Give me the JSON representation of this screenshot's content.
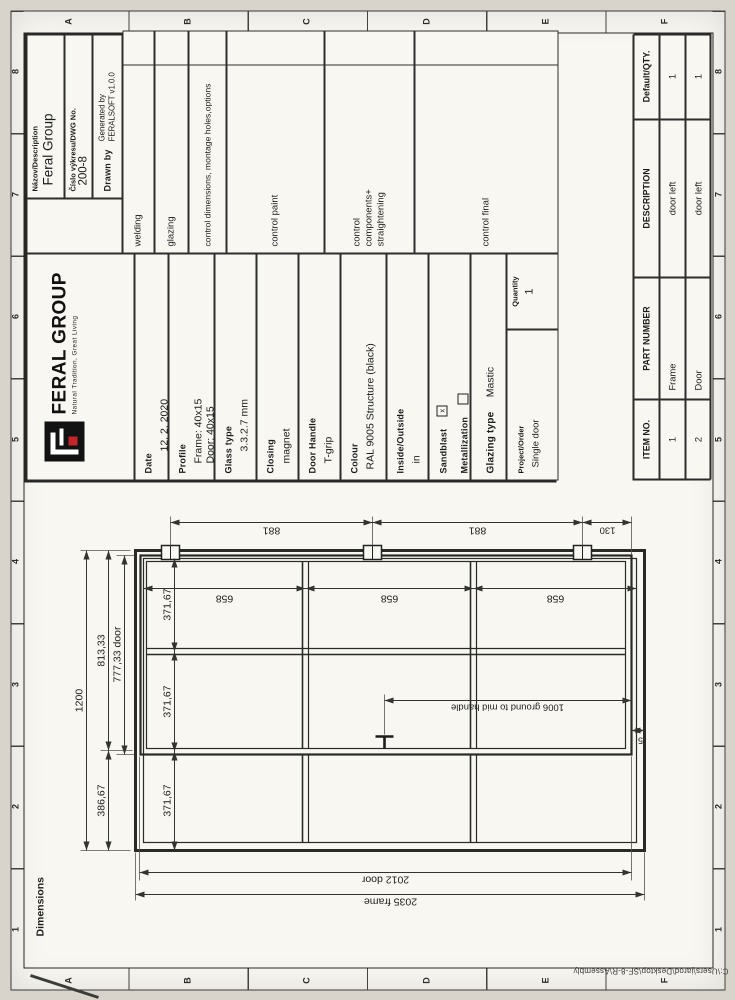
{
  "sheet": {
    "zone_numbers": [
      "1",
      "2",
      "3",
      "4",
      "5",
      "6",
      "7",
      "8"
    ],
    "zone_letters": [
      "A",
      "B",
      "C",
      "D",
      "E",
      "F"
    ],
    "footer_path": "C:\\Users\\jarod\\Desktop\\SF-8-R\\Assembly"
  },
  "title_block": {
    "logo_name": "FERAL GROUP",
    "logo_tagline": "Natural Tradition, Great Living",
    "name_label": "Názov/Description",
    "name_value": "Feral Group",
    "dwg_label": "Číslo výkresu/DWG No.",
    "dwg_value": "200-8",
    "drawn_by_label": "Drawn by",
    "drawn_by_value": "Generated by FERALSOFT v1.0.0",
    "checklist": [
      "welding",
      "glazing",
      "control dimensions, montage holes,options",
      "control paint",
      "control components+ straightening",
      "control final"
    ],
    "date_label": "Date",
    "date_value": "12. 2. 2020",
    "profile_label": "Profile",
    "profile_value1": "Frame: 40x15",
    "profile_value2": "Door: 40x15",
    "glass_label": "Glass type",
    "glass_value": "3.3.2.7 mm",
    "closing_label": "Closing",
    "closing_value": "magnet",
    "handle_label": "Door Handle",
    "handle_value": "T-grip",
    "colour_label": "Colour",
    "colour_value": "RAL 9005 Structure (black)",
    "inside_label": "Inside/Outside",
    "inside_value": "in",
    "sandblast_label": "Sandblast",
    "sandblast_value": "x",
    "metallization_label": "Metallization",
    "metallization_value": "",
    "glazing_label": "Glazing type",
    "glazing_value": "Mastic",
    "project_label": "Project/Order",
    "project_value": "Single door",
    "quantity_label": "Quantity",
    "quantity_value": "1"
  },
  "parts_table": {
    "headers": [
      "ITEM NO.",
      "PART NUMBER",
      "DESCRIPTION",
      "Default/QTY."
    ],
    "rows": [
      [
        "1",
        "Frame",
        "door left",
        "1"
      ],
      [
        "2",
        "Door",
        "door left",
        "1"
      ]
    ]
  },
  "drawing": {
    "view_label": "Dimensions",
    "dim_total_width": "1200",
    "dim_left_width": "386,67",
    "dim_right_width": "813,33",
    "dim_door_width": "777,33 door",
    "dim_col_width": "371,67",
    "dim_row_height": "658",
    "dim_hinge_spacing": "881",
    "dim_hinge_to_bottom": "130",
    "dim_door_height": "2012 door",
    "dim_frame_height": "2035 frame",
    "dim_handle": "1006 ground to mid handle",
    "dim_bottom_gap": "5"
  }
}
